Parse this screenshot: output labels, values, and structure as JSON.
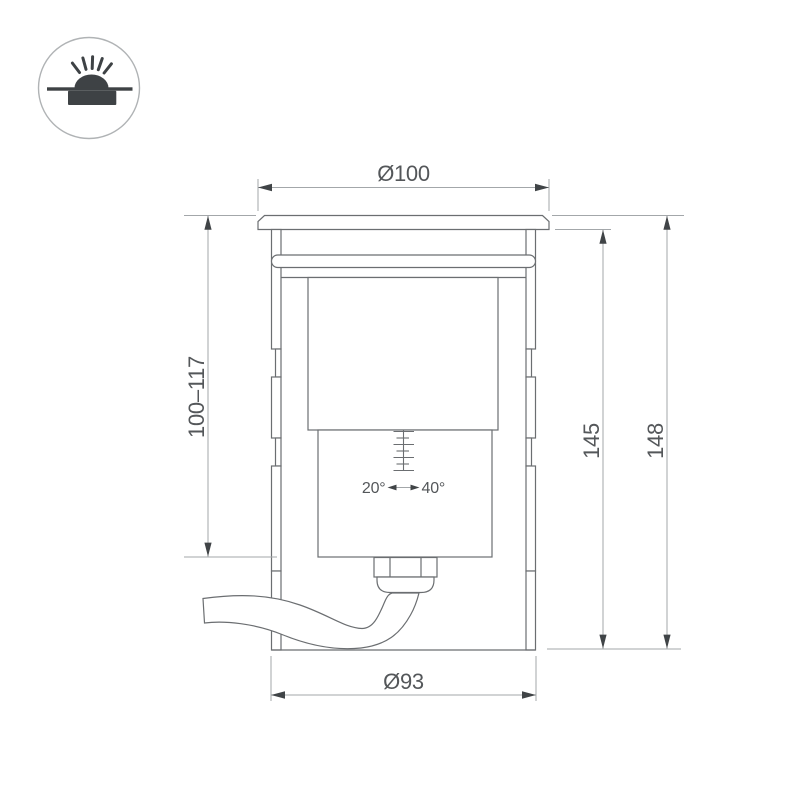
{
  "icon": {
    "name": "inground-recessed-light-icon"
  },
  "drawing": {
    "dim_top_diameter": "Ø100",
    "dim_recess_depth": "100–117",
    "dim_height_inner": "145",
    "dim_height_total": "148",
    "dim_bottom_diameter": "Ø93",
    "tilt_min_label": "20°",
    "tilt_max_label": "40°"
  },
  "colors": {
    "background": "#ffffff",
    "outline": "#6b6e71",
    "dimension_line": "#a3a7aa",
    "arrowhead": "#404447",
    "text": "#54575a",
    "icon_symbol": "#3e4245",
    "icon_ring": "#b0b3b5"
  }
}
